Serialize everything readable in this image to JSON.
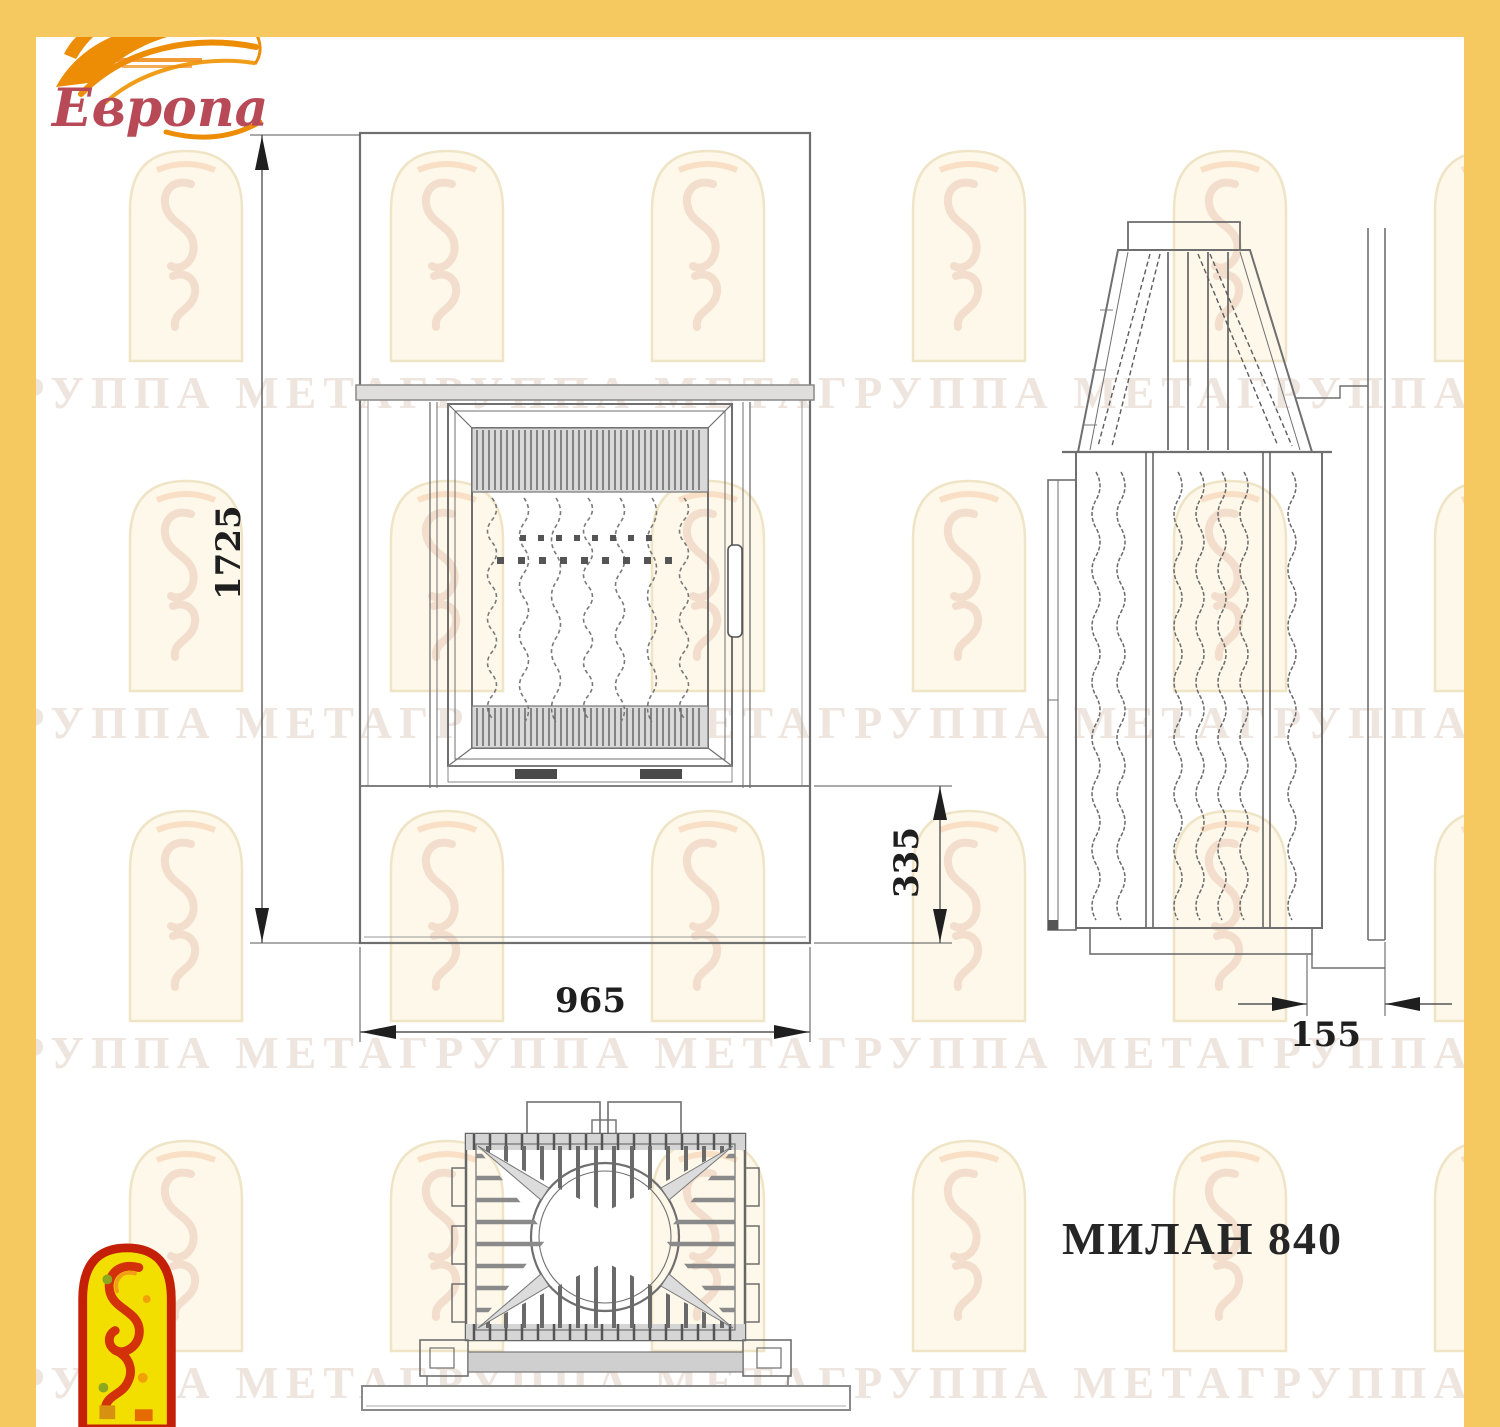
{
  "page": {
    "frame_color": "#f5c960",
    "model_label": "МИЛАН 840"
  },
  "logo": {
    "brand_text": "Европа",
    "brand_color": "#b84a58",
    "flame_color": "#ed8c05"
  },
  "watermark": {
    "text": "ГРУППА МЕТАГРУППА МЕТАГРУППА МЕТАГРУППА МЕТАГРУППА МЕТА"
  },
  "dimensions": {
    "overall_height": "1725",
    "overall_width": "965",
    "plinth_height": "335",
    "wall_depth": "155"
  }
}
